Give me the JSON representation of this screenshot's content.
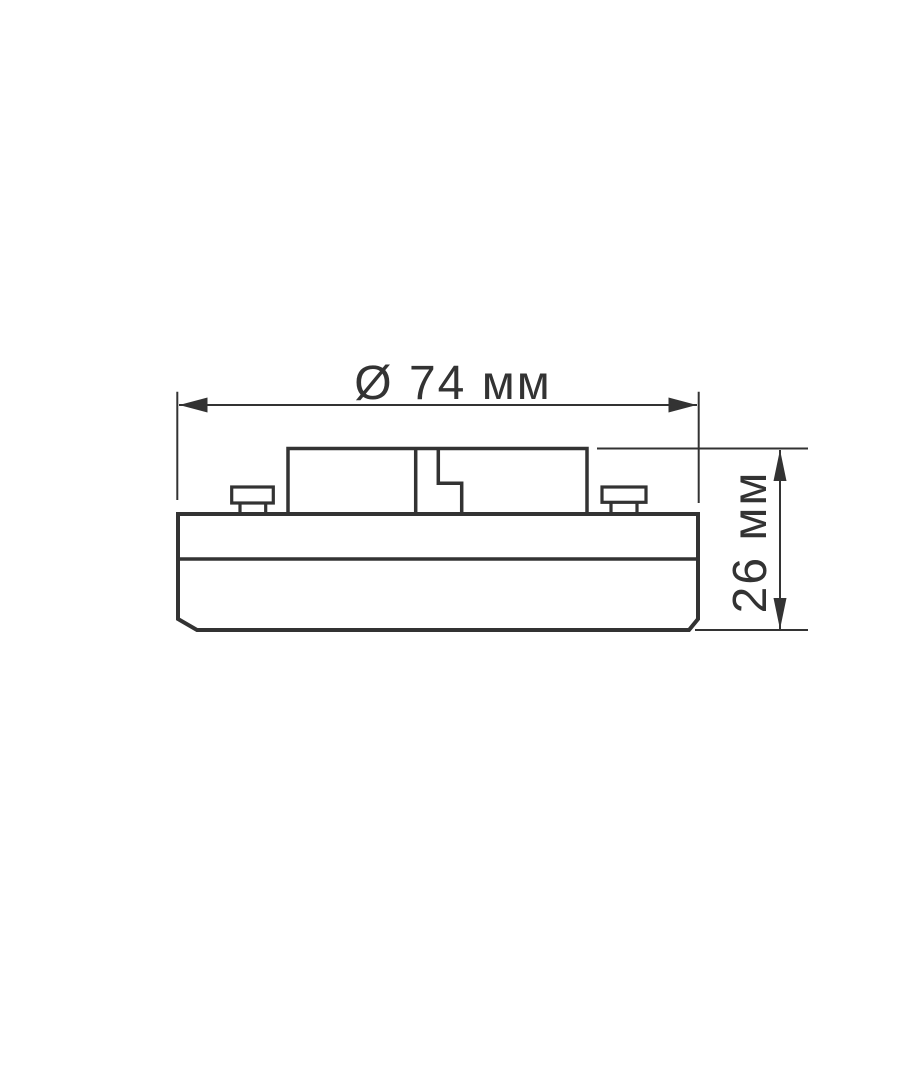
{
  "colors": {
    "line": "#333333",
    "background": "#ffffff"
  },
  "dimensions": {
    "diameter": {
      "label": "Ø 74 мм",
      "value": 74,
      "unit": "мм"
    },
    "height": {
      "label": "26 мм",
      "value": 26,
      "unit": "мм"
    }
  }
}
